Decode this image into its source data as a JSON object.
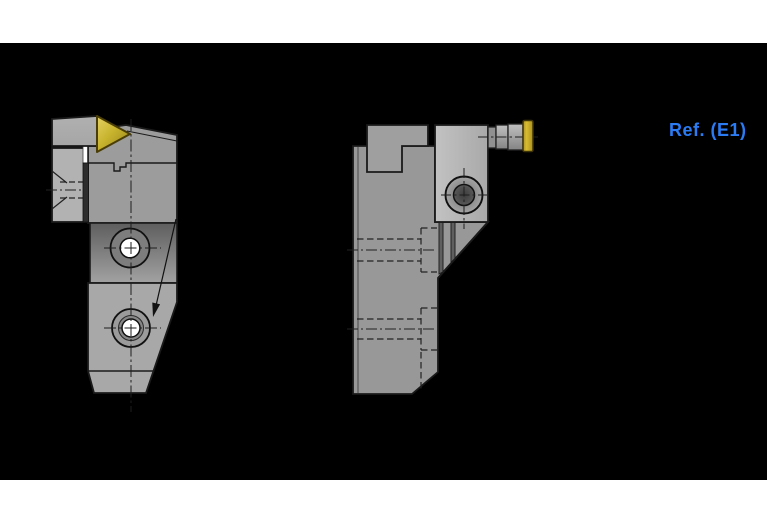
{
  "annotation": {
    "ref_label": "Ref. (E1)"
  },
  "parts": {
    "left_view": "tool-holder-front-view",
    "right_view": "tool-holder-side-view",
    "insert": "triangular-cutting-insert",
    "clamp": "top-clamp-block",
    "holes": [
      "mounting-hole-top",
      "mounting-hole-bottom"
    ],
    "screw": "clamp-screw-head",
    "connector": "coolant-connector",
    "cap": "coolant-cap"
  },
  "colors": {
    "background": "#ffffff",
    "drawing_background": "#000000",
    "outline": "#1a1a1a",
    "gray_clamp": "#a6a6a6",
    "gray_body": "#9c9c9c",
    "gray_band_dark": "#5e5e5e",
    "gray_band_light": "#a2a2a2",
    "gray_shank": "#a8a8a8",
    "gray_left_block": "#b2b2b2",
    "gray_plate": "#989898",
    "gray_tab": "#9f9f9f",
    "gray_head_light": "#c2c2c2",
    "gray_head": "#a9a9a9",
    "slot_dark": "#2d2d2d",
    "hole_white": "#ffffff",
    "insert_gold": "#c9b42e",
    "insert_gold_dark": "#93801a",
    "insert_gold_light": "#e4d163",
    "cap_gold": "#d9bc33",
    "cap_gold_dark": "#a8901c",
    "accent_blue": "#2b7bf3"
  }
}
